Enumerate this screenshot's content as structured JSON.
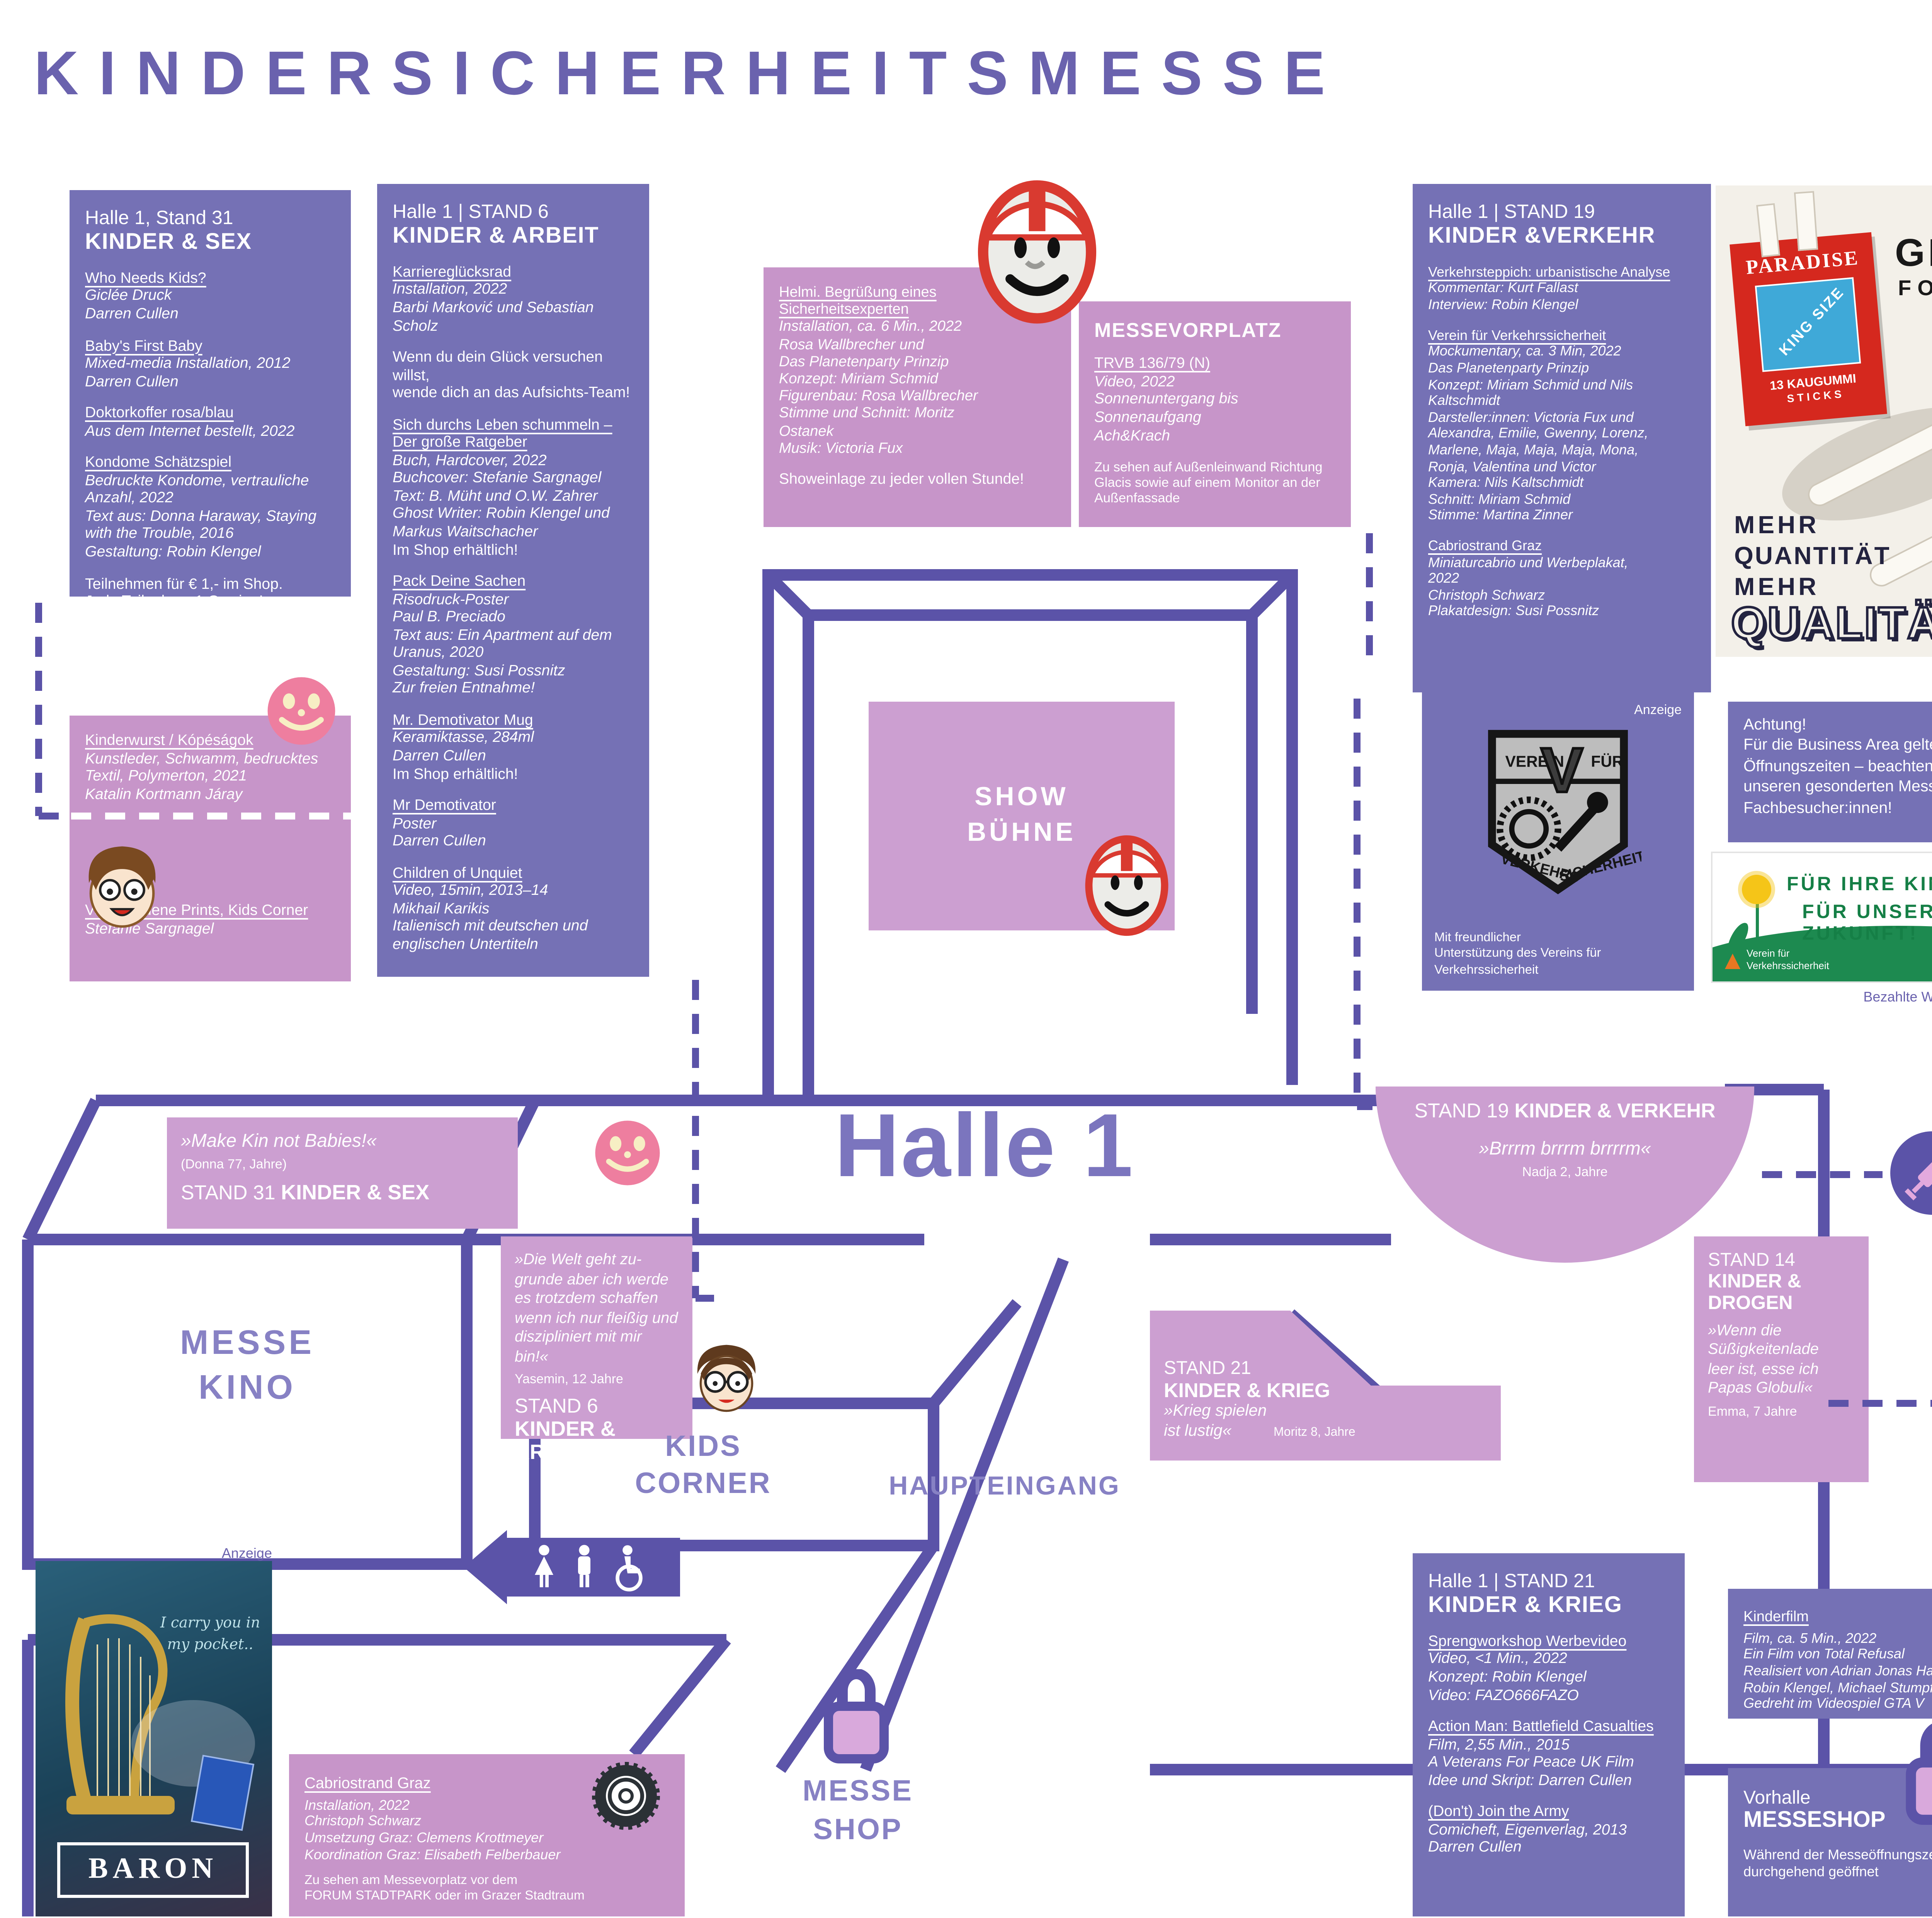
{
  "page": {
    "title": "KINDERSICHERHEITSMESSE",
    "year": "2022",
    "anzeige": "Anzeige",
    "bezahlt": "Bezahlte Werbeeinschaltung",
    "footer": "Änderungen vorbehalten, Updates auf forumstadtpark.at"
  },
  "info_box": {
    "name": "Kindersicherheitsmesse",
    "dates": "11.6. - 7.7.2022",
    "venue": "Forum Stadtpark, Stadtpark 1",
    "url": "www.forumstadtpark.at",
    "hours_label": "Öffnungszeiten:",
    "hours": "Di - Sa 14 -18:00 Uhr",
    "note": "Exklusiv für Privatbesucher:innen\nBusiness Partner bitte um Voranmeldung"
  },
  "aussteller": {
    "header": "Wichtige Aussteller:innen von A-Z",
    "rows": [
      {
        "n": "Ach&Krach",
        "l": "Außenfassade"
      },
      {
        "n": "Barbi Marković & Sebastian Scholz",
        "l": "Halle 1 / 6"
      },
      {
        "n": "B. Müht & O. W. Zahrer",
        "l": "Halle 1 / 6"
      },
      {
        "n": "Christoph Schwarz",
        "l": "Vorhof, Halle 1 / 19"
      },
      {
        "n": "Darren Cullen",
        "l": "Halle 1 / 6, 14, 21, 31"
      },
      {
        "n": "Das Planetenparty Prinzip",
        "l": "Showbühne, Halle 1 / 19"
      },
      {
        "n": "Donna Haraway",
        "l": "Halle 1 / 31"
      },
      {
        "n": "Dr. Sabine Haller, Impfgloryhole",
        "l": "Halle 1"
      },
      {
        "n": "Edith Payer",
        "l": "Halle 1 / 14"
      },
      {
        "n": "Katalin Kortmann Járay, Kinderwurst",
        "l": "Halle 1"
      },
      {
        "n": "Kurt Fallast",
        "l": "Halle 1 / 19"
      },
      {
        "n": "Mikhail Karikis",
        "l": "Messekino (Halle 1 / 6)"
      },
      {
        "n": "Rosa Wallbrecher",
        "l": "Showbühne"
      },
      {
        "n": "Stefanie Sargnagel",
        "l": "Kids Corner, Halle 1 / 6"
      },
      {
        "n": "Total Refusal",
        "l": "Halle 1 / 21"
      }
    ]
  },
  "stand31": {
    "hall": "Halle 1, Stand 31",
    "cat": "KINDER & SEX",
    "e": [
      {
        "t": "Who Needs Kids?",
        "d": "Giclée Druck\nDarren Cullen"
      },
      {
        "t": "Baby's First Baby",
        "d": "Mixed-media Installation, 2012\nDarren Cullen"
      },
      {
        "t": "Doktorkoffer rosa/blau",
        "d": "Aus dem Internet bestellt, 2022"
      },
      {
        "t": "Kondome Schätzspiel",
        "d": "Bedruckte Kondome, vertrauliche\nAnzahl, 2022\nText aus: Donna Haraway, Staying\nwith the Trouble, 2016\nGestaltung: Robin Klengel"
      }
    ],
    "note": "Teilnehmen für € 1,- im Shop.\nJede Teilnahme 1 Gewinn!"
  },
  "kinderwurst": {
    "e1": {
      "t": "Kinderwurst / Kópéságok",
      "d": "Kunstleder, Schwamm, bedrucktes\nTextil, Polymerton, 2021\nKatalin Kortmann Járay"
    },
    "e2": {
      "t": "Verschiedene Prints, Kids Corner",
      "d": "Stefanie Sargnagel"
    }
  },
  "stand6": {
    "hall": "Halle 1 | STAND 6",
    "cat": "KINDER & ARBEIT",
    "e": [
      {
        "t": "Karriereglücksrad",
        "d": "Installation, 2022\nBarbi Marković und Sebastian\nScholz"
      },
      {
        "t": "Sich durchs Leben schummeln – Der große Ratgeber",
        "d": "Buch, Hardcover, 2022\nBuchcover: Stefanie Sargnagel\nText: B. Müht und O.W. Zahrer\nGhost Writer: Robin Klengel und\nMarkus Waitschacher",
        "p": "Im Shop erhältlich!"
      },
      {
        "t": "Pack Deine Sachen",
        "d": "Risodruck-Poster\nPaul B. Preciado\nText aus: Ein Apartment auf dem\nUranus, 2020\nGestaltung: Susi Possnitz\nZur freien Entnahme!"
      },
      {
        "t": "Mr. Demotivator Mug",
        "d": "Keramiktasse, 284ml\nDarren Cullen",
        "p": "Im Shop erhältlich!"
      },
      {
        "t": "Mr Demotivator",
        "d": "Poster\nDarren Cullen"
      },
      {
        "t": "Children of Unquiet",
        "d": "Video, 15min, 2013–14\nMikhail Karikis\nItalienisch mit deutschen und\nenglischen Untertiteln"
      }
    ],
    "note": "Wenn du dein Glück versuchen willst,\nwende dich an das Aufsichts-Team!"
  },
  "helmi": {
    "t": "Helmi. Begrüßung eines Sicherheitsexperten",
    "d": "Installation, ca. 6 Min., 2022\nRosa Wallbrecher und\nDas Planetenparty Prinzip\nKonzept: Miriam Schmid\nFigurenbau: Rosa Wallbrecher\nStimme und Schnitt: Moritz\nOstanek\nMusik: Victoria Fux",
    "note": "Showeinlage zu jeder vollen Stunde!"
  },
  "messevorplatz": {
    "header": "MESSEVORPLATZ",
    "t": "TRVB 136/79 (N)",
    "d": "Video, 2022\nSonnenuntergang bis\nSonnenaufgang\nAch&Krach",
    "note": "Zu sehen auf Außenleinwand Richtung\nGlacis sowie auf einem Monitor an der\nAußenfassade"
  },
  "stand19": {
    "hall": "Halle 1 | STAND 19",
    "cat": "KINDER &VERKEHR",
    "e": [
      {
        "t": "Verkehrsteppich: urbanistische Analyse",
        "d": "Kommentar: Kurt Fallast\nInterview: Robin Klengel"
      },
      {
        "t": "Verein für Verkehrssicherheit",
        "d": "Mockumentary, ca. 3 Min, 2022\nDas Planetenparty Prinzip\nKonzept: Miriam Schmid und Nils\nKaltschmidt\nDarsteller:innen: Victoria Fux und\nAlexandra, Emilie, Gwenny, Lorenz,\nMarlene, Maja, Maja, Maja, Mona,\nRonja, Valentina und Victor\nKamera: Nils Kaltschmidt\nSchnitt: Miriam Schmid\nStimme: Martina Zinner"
      },
      {
        "t": "Cabriostrand Graz",
        "d": "Miniaturcabrio und Werbeplakat,\n2022\nChristoph Schwarz\nPlakatdesign: Susi Possnitz"
      }
    ]
  },
  "cig_ad": {
    "brand": "PARADISE",
    "kingsize": "KING SIZE",
    "sticks1": "13 KAUGUMMI",
    "sticks2": "S T I C K S",
    "h1": "GROSS",
    "h2": "FORMAT",
    "l1": "MEHR",
    "l2": "QUANTITÄT",
    "l3": "MEHR",
    "l4": "QUALITÄT"
  },
  "achtung": {
    "text": "Achtung!\nFür die Business Area gelten andere\nÖffnungszeiten – beachten Sie hierzu\nunseren gesonderten Messe-Guide für\nFachbesucher:innen!"
  },
  "verein_ad": {
    "anzeige": "Anzeige",
    "top_left": "VEREIN",
    "v": "V",
    "top_right": "FÜR",
    "b1": "VERKEHRS",
    "b2": "SICHERHEIT",
    "caption": "Mit freundlicher\nUnterstützung des Vereins für Verkehrssicherheit"
  },
  "zukunft": {
    "line1": "FÜR IHRE KINDER,",
    "line2": "FÜR UNSERE ZUKUNFT!",
    "logo": "Verein für\nVerkehrssicherheit"
  },
  "impfgloryhole": {
    "t": "Impfgloryhole",
    "d": "Von und mit Dr. Sybille Haller\nGeöffnet für Kinder mit geheimen\nImpfwunsch zwischen 5 und 12\nJahren"
  },
  "eroeffnung": {
    "h": "Messeeröffnung: 11.06.,\n12:00-22:00 Uhr",
    "attr": "Attraktionen:",
    "items": [
      "Fleischwundenschminken",
      "Kinder-Tätowieren mit Edith Payer",
      "Noppenfolie zerdrücken mit dem Hamster",
      "Gewinnspiele",
      "Schaumrollen",
      "Zuckerwatte",
      "Musik",
      "Und vieles mehr"
    ]
  },
  "stand14": {
    "hall": "Halle 1 | STAND 14",
    "cat": "KINDER & DROGEN",
    "e": [
      {
        "t": "Apotheke",
        "d": "Installation, verschiedene\nMaterialien, 2022\nEdith Payer"
      },
      {
        "t": "Fruity-Veggie-Summer-Camp",
        "d": "Rollbanner und tätowiertes\nObst und Gemüse, 2022\nEdith Payer"
      },
      {
        "t": "Sherbet Pipe",
        "d": "Poster/Objekt\nDarren Cullen"
      },
      {
        "t": "Tooth Fairy",
        "d": "Poster\nDarren Cullen"
      },
      {
        "t": "Multicoloured Bits Of Plastic",
        "d": "Plastik\nDarren Cullen"
      }
    ]
  },
  "fruity": {
    "w1": "FRUITY",
    "w2": "VEGGIE",
    "w3": "SUMMER",
    "w4": "DREAM",
    "badge": "TATTOO BOOT CAMP FOR KIDS",
    "skull": "☠"
  },
  "rauch": {
    "s1": "Mit dem",
    "s2": "verblüffend echten",
    "s3": "RAUCH–EFFEKT"
  },
  "stand21": {
    "hall": "Halle 1 | STAND 21",
    "cat": "KINDER & KRIEG",
    "e": [
      {
        "t": "Sprengworkshop Werbevideo",
        "d": "Video, <1 Min., 2022\nKonzept: Robin Klengel\nVideo: FAZO666FAZO"
      },
      {
        "t": "Action Man: Battlefield Casualties",
        "d": "Film, 2,55 Min., 2015\nA Veterans For Peace UK Film\nIdee und Skript: Darren Cullen"
      },
      {
        "t": "(Don't) Join the Army",
        "d": "Comicheft, Eigenverlag, 2013\nDarren Cullen"
      }
    ]
  },
  "kinderfilm": {
    "t": "Kinderfilm",
    "d": "Film, ca. 5 Min., 2022\nEin Film von Total Refusal\nRealisiert von Adrian Jonas Haim,\nRobin Klengel, Michael Stumpf\nGedreht im Videospiel GTA V"
  },
  "vorhalle": {
    "l1": "Vorhalle",
    "l2": "MESSESHOP",
    "note": "Während der Messeöffnungszeiten\ndurchgehend geöffnet"
  },
  "baron": {
    "tag": "I carry you in\nmy pocket..",
    "brand": "BARON"
  },
  "cabriostrand": {
    "t": "Cabriostrand Graz",
    "d": "Installation, 2022\nChristoph Schwarz\nUmsetzung Graz: Clemens Krottmeyer\nKoordination Graz: Elisabeth Felberbauer",
    "note": "Zu sehen am Messevorplatz vor dem\nFORUM STADTPARK oder im Grazer Stadtraum"
  },
  "map": {
    "halle": "Halle 1",
    "show": "SHOW\nBÜHNE",
    "kino": "MESSE\nKINO",
    "kids": "KIDS\nCORNER",
    "entrance": "HAUPTEINGANG",
    "shop": "MESSE\nSHOP",
    "s31": {
      "q": "»Make Kin not Babies!«",
      "a": "(Donna 77, Jahre)",
      "label": "STAND 31 ",
      "cat": "KINDER & SEX"
    },
    "s6": {
      "q": "»Die Welt geht zu-\ngrunde aber ich werde\nes trotzdem schaffen\nwenn ich nur fleißig und\ndiszipliniert mit mir bin!«",
      "a": "Yasemin, 12 Jahre",
      "label": "STAND 6",
      "cat": "KINDER & ARBEIT"
    },
    "s19": {
      "label": "STAND 19 ",
      "cat": "KINDER & VERKEHR",
      "q": "»Brrrm brrrm brrrrm«",
      "a": "Nadja 2, Jahre"
    },
    "s14": {
      "label": "STAND 14",
      "cat": "KINDER &\nDROGEN",
      "q": "»Wenn die\nSüßigkeitenlade\nleer ist, esse ich\nPapas Globuli«",
      "a": "Emma, 7 Jahre"
    },
    "s21": {
      "label": "STAND 21",
      "cat": "KINDER & KRIEG",
      "q": "»Krieg spielen\nist lustig«",
      "a": "Moritz 8, Jahre"
    }
  }
}
